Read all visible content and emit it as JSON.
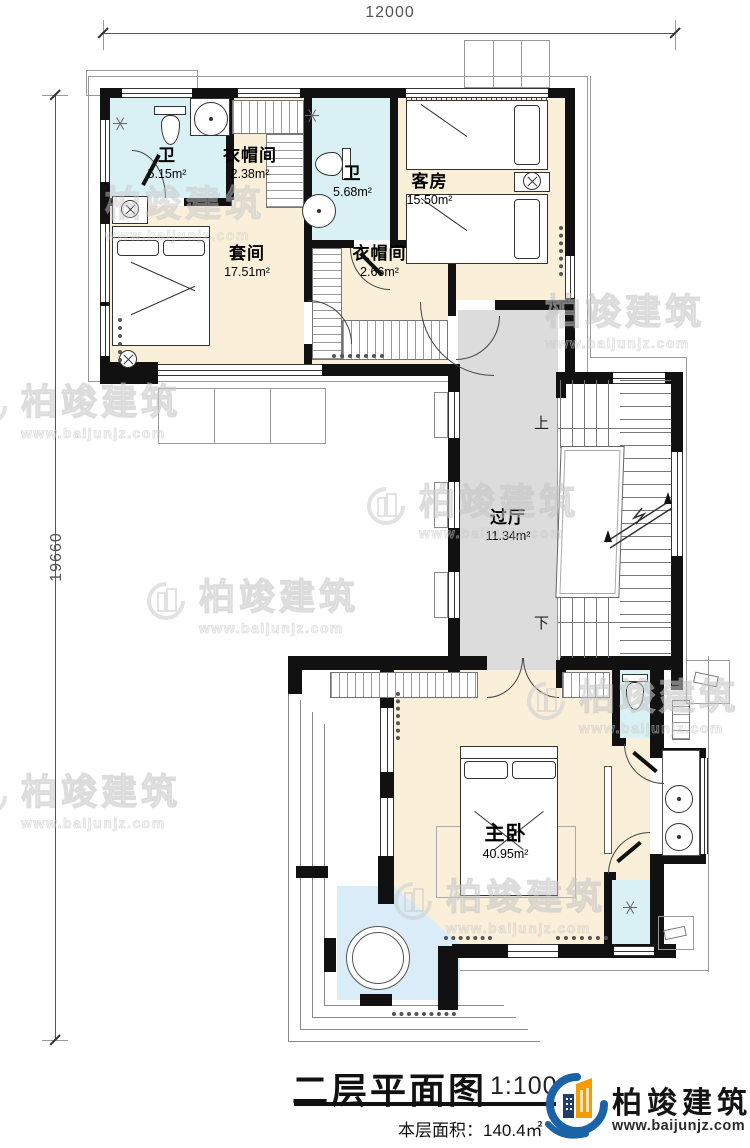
{
  "dimensions": {
    "width_top": "12000",
    "height_left": "19660"
  },
  "rooms": {
    "bath1": {
      "name": "卫",
      "area": "5.15m²"
    },
    "cloak1": {
      "name": "衣帽间",
      "area": "2.38m²"
    },
    "bath2": {
      "name": "卫",
      "area": "5.68m²"
    },
    "guest": {
      "name": "客房",
      "area": "15.50m²"
    },
    "suite": {
      "name": "套间",
      "area": "17.51m²"
    },
    "cloak2": {
      "name": "衣帽间",
      "area": "2.66m²"
    },
    "hall": {
      "name": "过厅",
      "area": "11.34m²"
    },
    "master": {
      "name": "主卧",
      "area": "40.95m²"
    }
  },
  "stairs": {
    "up_label": "上",
    "down_label": "下"
  },
  "title_block": {
    "title": "二层平面图",
    "scale": "1:100",
    "floor_area_label": "本层面积：",
    "floor_area_value": "140.4㎡"
  },
  "brand": {
    "name": "柏竣建筑",
    "url": "www.baijunjz.com"
  },
  "watermark": {
    "name": "柏竣建筑",
    "url": "www.baijunjz.com"
  },
  "colors": {
    "wall": "#111111",
    "bedroom_floor": "#faf0da",
    "bath_floor": "#d9f1f4",
    "hall_floor": "#dcdcdc",
    "balcony_floor": "#d9ecf8",
    "brand_blue": "#1b62a7",
    "brand_navy": "#1c3f6e",
    "brand_orange": "#f49c00"
  }
}
